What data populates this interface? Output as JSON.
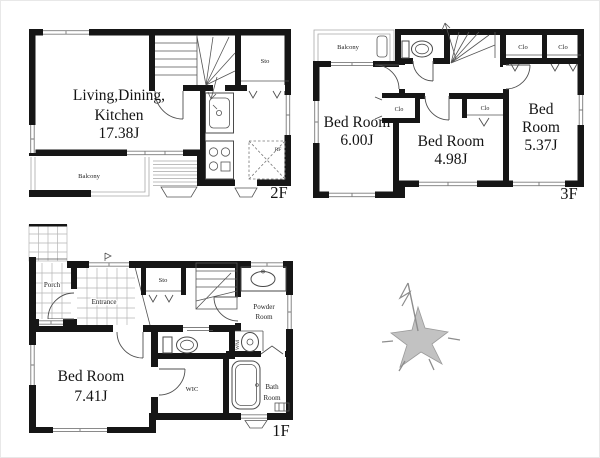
{
  "floor2": {
    "floor_label": "2F",
    "room_ldk_line1": "Living,Dining,",
    "room_ldk_line2": "Kitchen",
    "room_ldk_line3": "17.38J",
    "balcony_label": "Balcony",
    "storage_label": "Sto",
    "fridge_label": "RF"
  },
  "floor3": {
    "floor_label": "3F",
    "balcony_label": "Balcony",
    "bedroom1_line1": "Bed Room",
    "bedroom1_line2": "6.00J",
    "bedroom2_line1": "Bed Room",
    "bedroom2_line2": "4.98J",
    "bedroom3_line1": "Bed",
    "bedroom3_line2": "Room",
    "bedroom3_line3": "5.37J",
    "closet1_label": "Clo",
    "closet2_label": "Clo",
    "closet3_label": "Clo",
    "closet4_label": "Clo"
  },
  "floor1": {
    "floor_label": "1F",
    "porch_label": "Porch",
    "entrance_label": "Entrance",
    "storage_label": "Sto",
    "powder_line1": "Powder",
    "powder_line2": "Room",
    "washer_label": "WM",
    "wic_label": "WIC",
    "bedroom_line1": "Bed Room",
    "bedroom_line2": "7.41J",
    "bath_line1": "Bath",
    "bath_line2": "Room"
  }
}
